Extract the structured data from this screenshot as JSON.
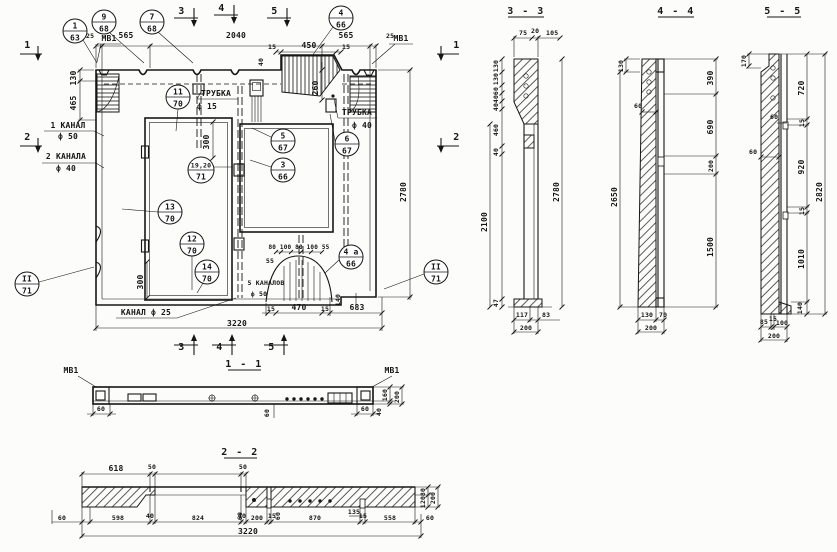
{
  "main": {
    "marks": {
      "t3": "3",
      "t4": "4",
      "t5": "5",
      "b3": "3",
      "b4": "4",
      "b5": "5",
      "l1": "1",
      "l2": "2",
      "r1": "1",
      "r2": "2"
    },
    "callouts": {
      "c1": {
        "n": "1",
        "p": "63"
      },
      "c9": {
        "n": "9",
        "p": "68"
      },
      "c7": {
        "n": "7",
        "p": "68"
      },
      "c4": {
        "n": "4",
        "p": "66"
      },
      "c11": {
        "n": "11",
        "p": "70"
      },
      "c5": {
        "n": "5",
        "p": "67"
      },
      "c6": {
        "n": "6",
        "p": "67"
      },
      "c3": {
        "n": "3",
        "p": "66"
      },
      "c1920": {
        "n": "19,20",
        "p": "71"
      },
      "c13": {
        "n": "13",
        "p": "70"
      },
      "c12": {
        "n": "12",
        "p": "70"
      },
      "c14": {
        "n": "14",
        "p": "70"
      },
      "c4a": {
        "n": "4 a",
        "p": "66"
      },
      "cIIl": {
        "n": "II",
        "p": "71"
      },
      "cIIr": {
        "n": "II",
        "p": "71"
      }
    },
    "texts": {
      "mv1l": "МВ1",
      "mv1r": "МВ1",
      "kanal1a": "1 КАНАЛ",
      "kanal1b": "ф 50",
      "kanal2a": "2 КАНАЛА",
      "kanal2b": "ф 40",
      "tr15a": "ТРУБКА",
      "tr15b": "ф 15",
      "tr40a": "ТРУБКА",
      "tr40b": "ф 40",
      "kanal25": "КАНАЛ ф 25",
      "k5a": "5 КАНАЛОВ",
      "k5b": "ф 50"
    },
    "dims": {
      "d25l": "25",
      "d565l": "565",
      "d2040": "2040",
      "d565r": "565",
      "d25r": "25",
      "d15a": "15",
      "d450": "450",
      "d15b": "15",
      "d40v": "40",
      "d130": "130",
      "d465": "465",
      "d300a": "300",
      "d260": "260",
      "d300b": "300",
      "d2780": "2780",
      "row": "80 100 80 100 55",
      "d55": "55",
      "d140": "140",
      "d15c": "15",
      "d470": "470",
      "d15d": "15",
      "d683": "683",
      "d3220": "3220"
    }
  },
  "s33": {
    "title": "3 - 3",
    "top": [
      "75",
      "20",
      "105"
    ],
    "stack": [
      "130",
      "130",
      "60",
      "40",
      "40",
      "460",
      "40"
    ],
    "d2100": "2100",
    "d47": "47",
    "d2780": "2780",
    "d117": "117",
    "d83": "83",
    "d200": "200"
  },
  "s44": {
    "title": "4 - 4",
    "d130": "130",
    "d2650": "2650",
    "d60": "60",
    "right": [
      "390",
      "690",
      "200",
      "1500"
    ],
    "d130b": "130",
    "d70": "70",
    "d200": "200"
  },
  "s55": {
    "title": "5 - 5",
    "d170": "170",
    "d60a": "60",
    "d60b": "60",
    "right": [
      "720",
      "15",
      "920",
      "15",
      "1010",
      "140"
    ],
    "d2820": "2820",
    "d85": "85",
    "d15": "15",
    "d100": "100",
    "d200": "200"
  },
  "s11": {
    "title": "1 - 1",
    "mv1l": "МВ1",
    "mv1r": "МВ1",
    "d60l": "60",
    "d60c": "60",
    "d60r": "60",
    "d160": "160",
    "d40": "40",
    "d200": "200"
  },
  "s22": {
    "title": "2 - 2",
    "d618": "618",
    "d50a": "50",
    "d50b": "50",
    "bottom": [
      "60",
      "598",
      "40",
      "824",
      "40",
      "200",
      "15",
      "870",
      "15",
      "558",
      "60"
    ],
    "d135": "135",
    "d60a": "60",
    "d60b": "60",
    "d3220": "3220",
    "d80": "80",
    "d120": "120",
    "d200": "200"
  }
}
